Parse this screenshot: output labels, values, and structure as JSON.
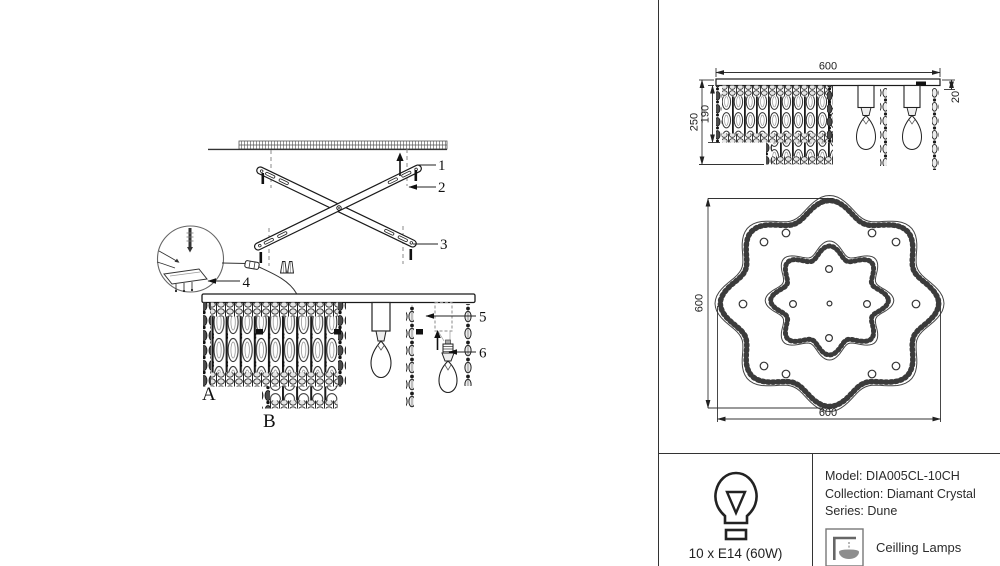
{
  "colors": {
    "line": "#222222",
    "dim": "#333333",
    "mesh_dark": "#3a3a3a",
    "background": "#ffffff"
  },
  "assembly": {
    "callout_1": "1",
    "callout_2": "2",
    "callout_3": "3",
    "callout_4": "4",
    "callout_5": "5",
    "callout_6": "6",
    "label_a": "A",
    "label_b": "B"
  },
  "side_view": {
    "dim_width": "600",
    "dim_height_total": "250",
    "dim_height_body": "190",
    "dim_plate_offset": "20"
  },
  "top_view": {
    "dim_height": "600",
    "dim_width": "600"
  },
  "spec_box": {
    "bulb_spec": "10 x E14 (60W)",
    "model_label": "Model:",
    "model_value": "DIA005CL-10CH",
    "collection_label": "Collection:",
    "collection_value": "Diamant Crystal",
    "series_label": "Series:",
    "series_value": "Dune",
    "category": "Ceilling Lamps",
    "icons": {
      "bulb": "bulb-icon",
      "ceiling_lamp": "ceiling-lamp-icon"
    }
  }
}
